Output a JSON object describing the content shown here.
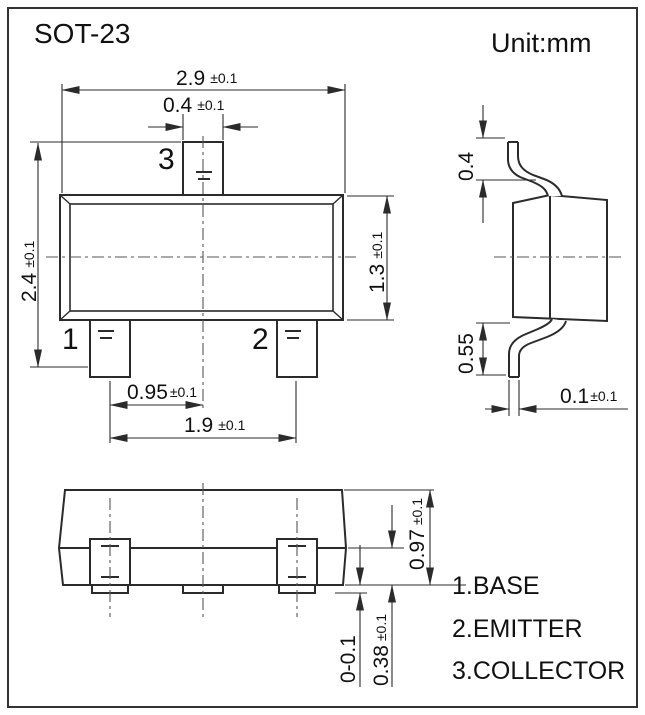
{
  "title": "SOT-23",
  "unit_label": "Unit:mm",
  "front_view": {
    "pin1": "1",
    "pin2": "2",
    "pin3": "3",
    "dim_overall_width": {
      "value": "2.9",
      "tol": "±0.1"
    },
    "dim_tab_width": {
      "value": "0.4",
      "tol": "±0.1"
    },
    "dim_overall_height": {
      "value": "2.4",
      "tol": "±0.1"
    },
    "dim_body_height": {
      "value": "1.3",
      "tol": "±0.1"
    },
    "dim_pin_pitch": {
      "value": "0.95",
      "tol": "±0.1"
    },
    "dim_pin_span": {
      "value": "1.9",
      "tol": "±0.1"
    }
  },
  "side_view": {
    "dim_lead_width": {
      "value": "0.4"
    },
    "dim_lead_length": {
      "value": "0.55"
    },
    "dim_lead_thickness": {
      "value": "0.1",
      "tol": "±0.1"
    }
  },
  "bottom_view": {
    "dim_bottom_height": {
      "value": "0.97",
      "tol": "±0.1"
    },
    "dim_standoff": {
      "value": "0-0.1"
    },
    "dim_foot_length": {
      "value": "0.38",
      "tol": "±0.1"
    }
  },
  "legend": {
    "item1": "1.BASE",
    "item2": "2.EMITTER",
    "item3": "3.COLLECTOR"
  },
  "colors": {
    "line": "#2b2b2b",
    "centerline": "#555555",
    "text": "#111111",
    "background": "#ffffff"
  }
}
